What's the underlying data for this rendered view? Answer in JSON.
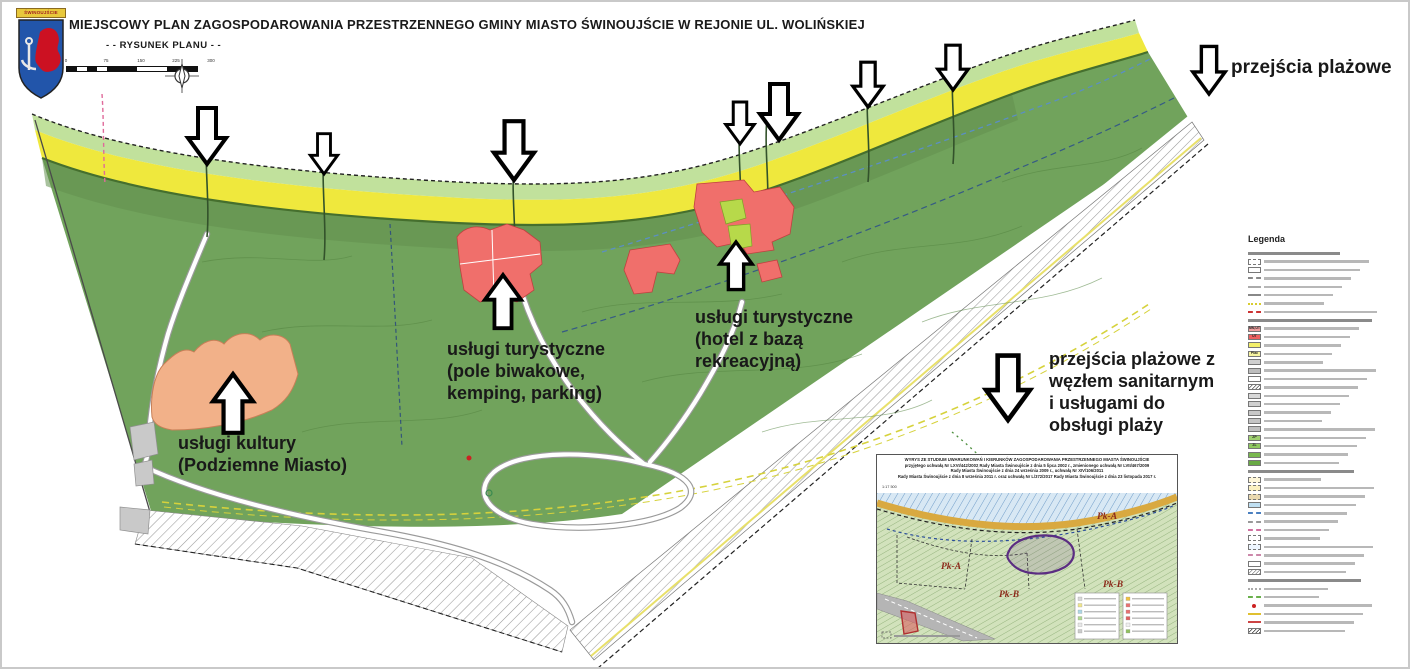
{
  "header": {
    "title": "MIEJSCOWY PLAN ZAGOSPODAROWANIA PRZESTRZENNEGO GMINY MIASTO ŚWINOUJŚCIE W REJONIE UL. WOLIŃSKIEJ",
    "subtitle": "- - RYSUNEK PLANU - -",
    "crest_banner": "ŚWINOUJŚCIE"
  },
  "scalebar": {
    "ticks": [
      "0",
      "75",
      "150",
      "225",
      "300"
    ]
  },
  "annotations": {
    "beach_crossings": {
      "lines": [
        "przejścia plażowe"
      ]
    },
    "culture": {
      "lines": [
        "usługi kultury",
        "(Podziemne Miasto)"
      ]
    },
    "tourism_camping": {
      "lines": [
        "usługi turystyczne",
        "(pole biwakowe,",
        "kemping, parking)"
      ]
    },
    "tourism_hotel": {
      "lines": [
        "usługi turystyczne",
        "(hotel z bazą",
        "rekreacyjną)"
      ]
    },
    "beach_sanitary": {
      "lines": [
        "przejścia plażowe z",
        "węzłem sanitarnym",
        "i usługami do",
        "obsługi plaży"
      ]
    }
  },
  "legend": {
    "title": "Legenda",
    "rows": [
      {
        "t": "header"
      },
      {
        "t": "box",
        "bg": "#ffffff",
        "bd": "dashed"
      },
      {
        "t": "box",
        "bg": "#ffffff",
        "bd": "solid"
      },
      {
        "t": "line",
        "c": "#888888",
        "st": "dashed"
      },
      {
        "t": "line",
        "c": "#aaaaaa",
        "st": "solid"
      },
      {
        "t": "line",
        "c": "#888888",
        "st": "solid"
      },
      {
        "t": "line",
        "c": "#d8cc30",
        "st": "dotted"
      },
      {
        "t": "line",
        "c": "#cc3333",
        "st": "dashed"
      },
      {
        "t": "header"
      },
      {
        "t": "box",
        "bg": "#ef9f9f",
        "code": "MN,UT"
      },
      {
        "t": "box",
        "bg": "#ee5f5f",
        "code": "UT"
      },
      {
        "t": "box",
        "bg": "#f3ef6a",
        "code": ""
      },
      {
        "t": "box",
        "bg": "#f6f3a0",
        "code": "Plac"
      },
      {
        "t": "box",
        "bg": "#cfcfcf",
        "code": ""
      },
      {
        "t": "box",
        "bg": "#bdbdbd",
        "code": ""
      },
      {
        "t": "box",
        "bg": "#ffffff",
        "code": ""
      },
      {
        "t": "hatch",
        "c": "#555555"
      },
      {
        "t": "box",
        "bg": "#d8d8d8",
        "code": ""
      },
      {
        "t": "box",
        "bg": "#d0d0d0",
        "code": ""
      },
      {
        "t": "box",
        "bg": "#c8c8c8",
        "code": ""
      },
      {
        "t": "box",
        "bg": "#c4c4c4",
        "code": ""
      },
      {
        "t": "box",
        "bg": "#bfbfbf",
        "code": ""
      },
      {
        "t": "box",
        "bg": "#9fcf70",
        "code": "ZP"
      },
      {
        "t": "box",
        "bg": "#8fc860",
        "code": "ZL"
      },
      {
        "t": "box",
        "bg": "#79b84e",
        "code": ""
      },
      {
        "t": "box",
        "bg": "#69aa45",
        "code": ""
      },
      {
        "t": "header"
      },
      {
        "t": "box",
        "bg": "#fdf6d8",
        "bd": "dashed"
      },
      {
        "t": "box",
        "bg": "#faf0c0",
        "bd": "dashed"
      },
      {
        "t": "box",
        "bg": "#e9d9b0",
        "bd": "dashed"
      },
      {
        "t": "box",
        "bg": "#bfdff2",
        "bd": "solid"
      },
      {
        "t": "line",
        "c": "#4a7fc0",
        "st": "dashed"
      },
      {
        "t": "line",
        "c": "#999999",
        "st": "dashed"
      },
      {
        "t": "line",
        "c": "#d070a0",
        "st": "dashed"
      },
      {
        "t": "box",
        "bg": "#ffffff",
        "bd": "dashed"
      },
      {
        "t": "box",
        "bg": "#eef6ff",
        "bd": "dashed"
      },
      {
        "t": "line",
        "c": "#cc88aa",
        "st": "dashed"
      },
      {
        "t": "box",
        "bg": "#ffffff",
        "bd": "solid"
      },
      {
        "t": "hatch",
        "c": "#888888"
      },
      {
        "t": "header"
      },
      {
        "t": "line",
        "c": "#aaaaaa",
        "st": "dotted"
      },
      {
        "t": "line",
        "c": "#6ab04c",
        "st": "dashed"
      },
      {
        "t": "dot",
        "c": "#cc2222"
      },
      {
        "t": "line",
        "c": "#e0c030",
        "st": "solid"
      },
      {
        "t": "line",
        "c": "#cc4444",
        "st": "solid"
      },
      {
        "t": "hatch",
        "c": "#333333"
      }
    ]
  },
  "inset": {
    "title_lines": [
      "WYRYS ZE STUDIUM UWARUNKOWAŃ I KIERUNKÓW ZAGOSPODAROWANIA PRZESTRZENNEGO MIASTA ŚWINOUJŚCIE",
      "przyjętego uchwałą Nr LXVI/442/2002 Rady Miasta Świnoujście z dnia 5 lipca 2002 r., zmienionego uchwałą Nr LVII/467/2009",
      "Rady Miasta Świnoujście z dnia 24 września 2009 r., uchwałą Nr XIV/106/2011",
      "Rady Miasta Świnoujście z dnia 8 września 2011 r. oraz uchwałą Nr L/372/2017 Rady Miasta Świnoujście z dnia 23 listopada 2017 r."
    ],
    "scale_label": "1:17 500",
    "area_labels": [
      "Pk-A",
      "Pk-A",
      "Pk-B",
      "Pk-B"
    ]
  },
  "map": {
    "colors": {
      "sea": "#ffffff",
      "dune_grass": "#c1e19c",
      "beach": "#efe83d",
      "forest": "#71a35c",
      "tourism_red": "#f06f6b",
      "culture_salmon": "#f2b189",
      "greenery_lime": "#b7d94a"
    },
    "arrows": [
      {
        "tx": 205,
        "ty": 162,
        "dir": "down",
        "s": 1.0
      },
      {
        "tx": 322,
        "ty": 172,
        "dir": "down",
        "s": 0.72
      },
      {
        "tx": 512,
        "ty": 178,
        "dir": "down",
        "s": 1.05
      },
      {
        "tx": 738,
        "ty": 142,
        "dir": "down",
        "s": 0.75
      },
      {
        "tx": 777,
        "ty": 138,
        "dir": "down",
        "s": 1.0
      },
      {
        "tx": 866,
        "ty": 105,
        "dir": "down",
        "s": 0.8
      },
      {
        "tx": 951,
        "ty": 88,
        "dir": "down",
        "s": 0.8
      },
      {
        "tx": 1207,
        "ty": 92,
        "dir": "down",
        "s": 0.85
      },
      {
        "tx": 1006,
        "ty": 418,
        "dir": "down",
        "s": 1.15
      },
      {
        "tx": 231,
        "ty": 372,
        "dir": "up",
        "s": 1.05
      },
      {
        "tx": 501,
        "ty": 273,
        "dir": "up",
        "s": 0.95
      },
      {
        "tx": 734,
        "ty": 240,
        "dir": "up",
        "s": 0.85
      }
    ]
  }
}
